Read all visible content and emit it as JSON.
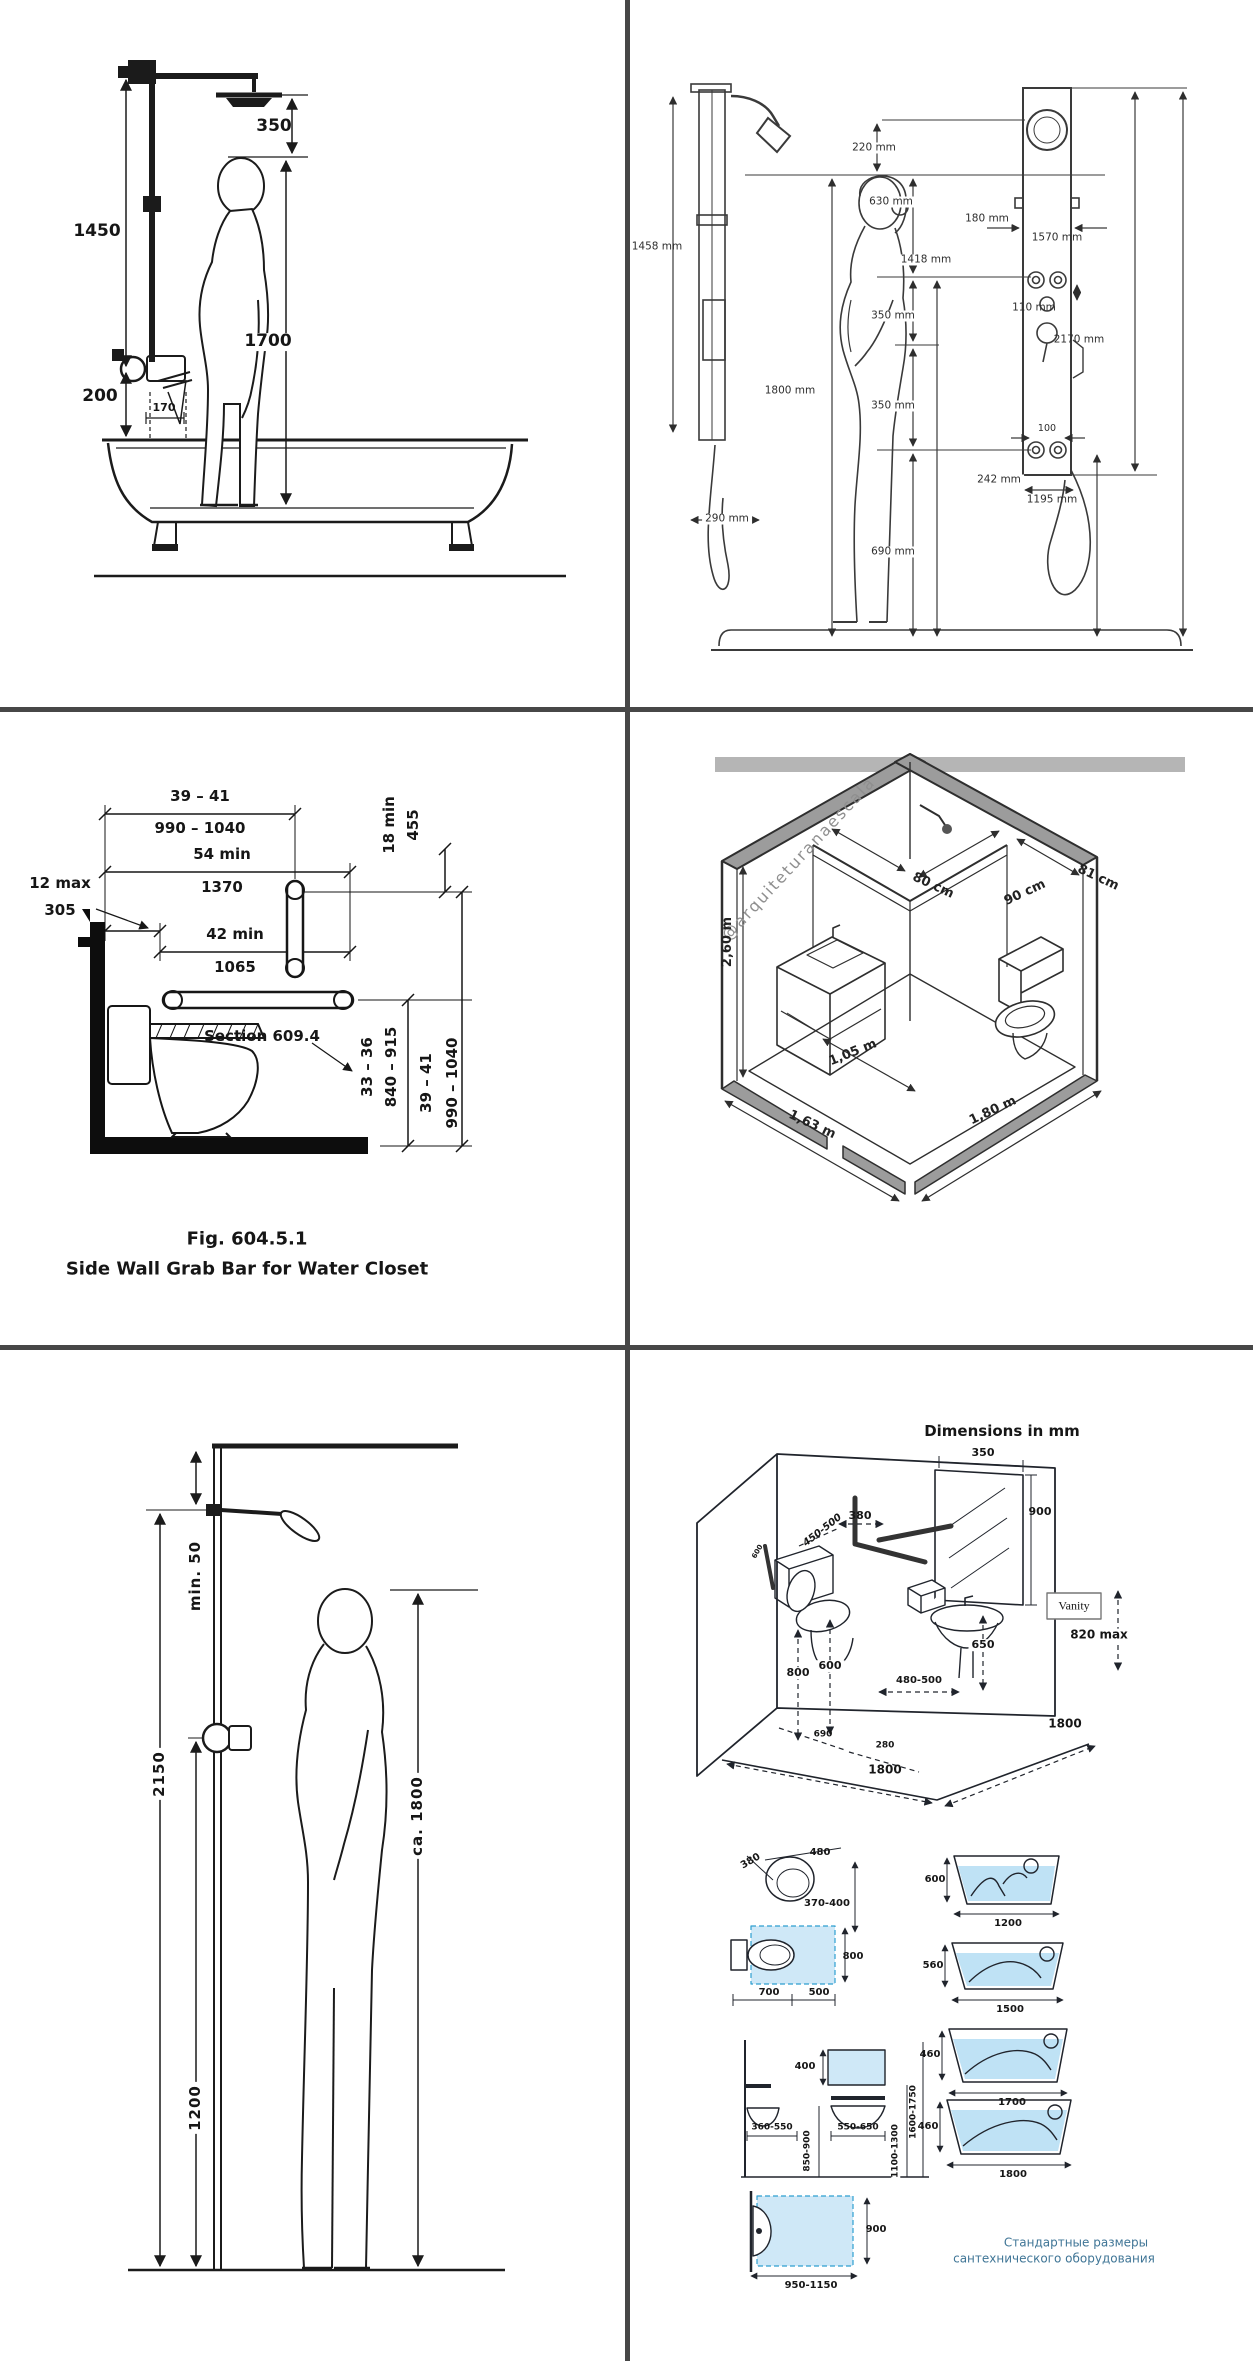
{
  "panels": {
    "shower_tub": {
      "labels": {
        "head_clearance": "350",
        "riser_height": "1450",
        "standing_height": "1700",
        "spout_height": "200",
        "spout_depth": "170"
      }
    },
    "shower_panel": {
      "labels": {
        "side_height": "1458 mm",
        "side_depth": "290 mm",
        "person_height": "1800 mm",
        "head_clearance": "220 mm",
        "head_drop": "630 mm",
        "jets_height": "1418 mm",
        "panel_width": "180 mm",
        "panel_height": "1570 mm",
        "knob_spacing": "110 mm",
        "jet_gap_upper": "350 mm",
        "jet_gap_lower": "350 mm",
        "jet_spacing": "100",
        "base_width": "242 mm",
        "hose_height": "1195 mm",
        "floor_clearance": "690 mm",
        "total_height": "2170 mm"
      }
    },
    "grab_bar": {
      "labels": {
        "bar_length_in": "39 – 41",
        "bar_length_mm": "990 – 1040",
        "wall_run_in": "54 min",
        "wall_run_mm": "1370",
        "rear_offset_in": "12 max",
        "rear_offset_mm": "305",
        "front_ext_in": "42 min",
        "front_ext_mm": "1065",
        "vert_bar_in": "18 min",
        "vert_bar_mm": "455",
        "section_ref": "Section 609.4",
        "seat_height_in": "33 – 36",
        "seat_height_mm": "840 – 915",
        "bar_height_in": "39 – 41",
        "bar_height_mm": "990 – 1040"
      },
      "caption_fig": "Fig. 604.5.1",
      "caption_title": "Side Wall Grab Bar for Water Closet"
    },
    "iso_bathroom": {
      "watermark": "@arquiteturanaescala",
      "labels": {
        "shower_width": "80 cm",
        "shower_depth": "90 cm",
        "side_wall": "81 cm",
        "ceiling_height": "2,60 m",
        "vanity_run": "1,05 m",
        "room_width": "1,63 m",
        "room_depth": "1,80 m"
      }
    },
    "shower_user": {
      "labels": {
        "arm_clearance": "min. 50",
        "pipe_height": "2150",
        "valve_height": "1200",
        "person_height": "ca. 1800"
      }
    },
    "accessible_bathroom": {
      "title": "Dimensions in mm",
      "vanity_label": "Vanity",
      "labels": {
        "mirror_width": "350",
        "mirror_height": "900",
        "cistern_gap": "380",
        "grab_bar_zone": "450-500",
        "wall_note": "600",
        "toilet_rear_height": "800",
        "toilet_seat_height": "600",
        "toilet_front": "480-500",
        "basin_clearance": "650",
        "vanity_height": "820 max",
        "toilet_side": "690",
        "toilet_center": "280",
        "room_width": "1800",
        "room_depth": "1800"
      },
      "toilet_top": {
        "width": "480",
        "depth": "380",
        "height": "370-400"
      },
      "toilet_plan": {
        "depth": "800",
        "rear": "700",
        "front": "500"
      },
      "basin_elevation": {
        "mirror": "400",
        "basin_small": "360-550",
        "basin_large": "550-650",
        "height_basin": "850-900",
        "height_mirror": "1100-1300",
        "height_top": "1600-1750"
      },
      "basin_plan": {
        "depth": "900",
        "width": "950-1150"
      },
      "bathtubs": [
        {
          "height": "600",
          "length": "1200"
        },
        {
          "height": "560",
          "length": "1500"
        },
        {
          "height": "460",
          "length": "1700"
        },
        {
          "height": "460",
          "length": "1800"
        }
      ],
      "caption": {
        "line1": "Стандартные размеры",
        "line2": "сантехнического оборудования"
      }
    }
  }
}
